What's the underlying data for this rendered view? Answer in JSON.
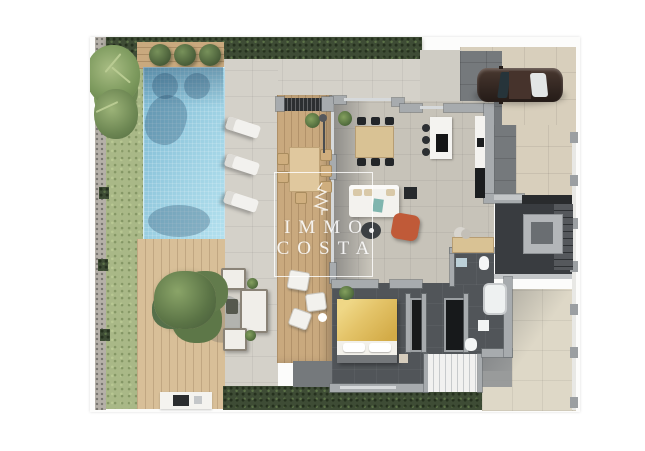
{
  "watermark": {
    "line1": "IMMO",
    "line2": "COSTA"
  },
  "palette": {
    "grass": "#a9b887",
    "hedge": "#3e4c35",
    "pool_light": "#9fd2e4",
    "pool_mid": "#7db9d3",
    "wood": "#c9a97e",
    "wood_light": "#d8bf98",
    "pave": "#d4d1c9",
    "pave_dark": "#75797c",
    "floor": "#c7c3b9",
    "floor_dark": "#515559",
    "wall": "#a7abae",
    "wall_light": "#d6d9db",
    "drive": "#d8cfbc",
    "patio": "#ded8c7",
    "car": "#3a2c26",
    "bed_yellow": "#e4c469",
    "terracotta": "#c05a38",
    "black_unit": "#1b1d1f",
    "white_furniture": "#f3f2ee"
  }
}
